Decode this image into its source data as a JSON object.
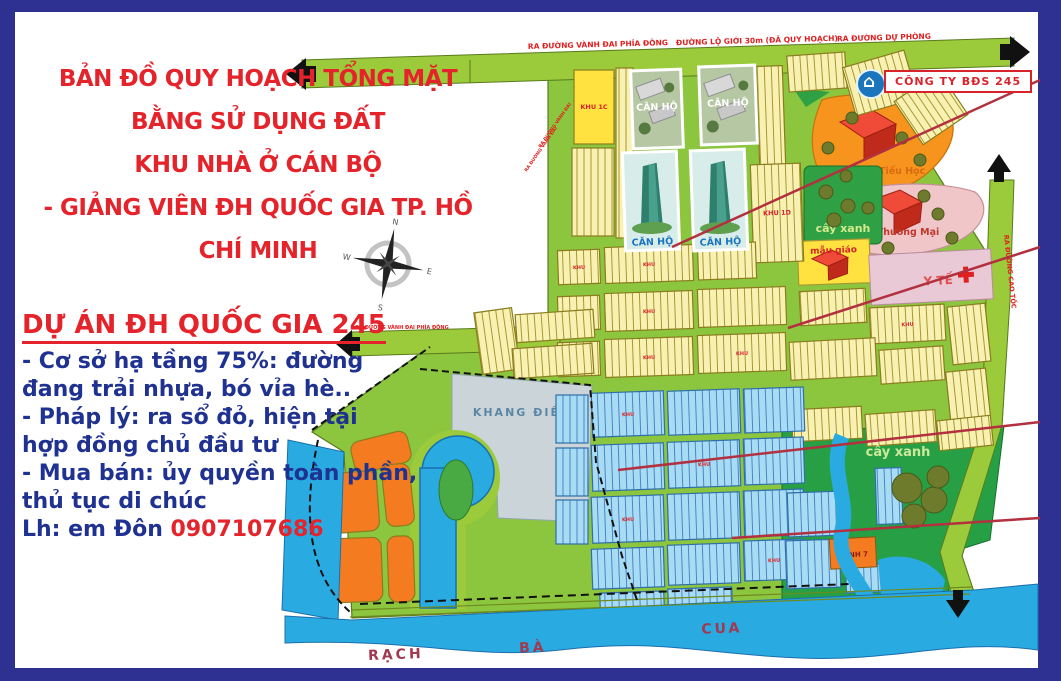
{
  "title": {
    "line1": "BẢN ĐỒ QUY HOẠCH TỔNG MẶT BẰNG SỬ DỤNG ĐẤT",
    "line2": "KHU NHÀ Ở CÁN BỘ",
    "line3": "- GIẢNG VIÊN ĐH QUỐC GIA TP. HỒ CHÍ MINH"
  },
  "info_panel": {
    "heading": "DỰ ÁN ĐH QUỐC GIA 245",
    "lines": [
      "- Cơ sở hạ tầng 75%: đường",
      "đang trải nhựa, bó vỉa hè..",
      "- Pháp lý:  ra sổ đỏ, hiện tại",
      "hợp đồng chủ đầu tư",
      "- Mua bán: ủy quyền toàn phần,",
      "thủ tục di chúc"
    ],
    "contact_label": "Lh: em Đôn ",
    "contact_phone": "0907107686"
  },
  "company_badge": {
    "label": "CÔNG TY BĐS 245",
    "icon": "house-icon"
  },
  "roads": {
    "top_left": "RA ĐƯỜNG VÀNH ĐAI PHÍA ĐÔNG",
    "top_center": "ĐƯỜNG LỘ GIỚI 30m (ĐÃ QUY HOẠCH)",
    "top_right": "RA ĐƯỜNG DỰ PHÒNG",
    "highway_right": "RA ĐƯỜNG CAO TỐC",
    "west_arm": "RA ĐƯỜNG VÀNH ĐAI PHÍA ĐÔNG",
    "left_diagonal": "RA ĐƯỜNG VÀNH ĐAI"
  },
  "map": {
    "labels": {
      "khu_1c": "KHU 1C",
      "khu_1d": "KHU 1D",
      "khu_generic": "KHU",
      "can_ho": "CĂN HỘ",
      "truong_tieu_hoc": "Trường Tiểu Học",
      "thuong_mai": "Thương Mại",
      "cay_xanh": "cây xanh",
      "mau_giao": "mẫu giáo",
      "y_te": "Y TẾ",
      "khang_dien": "KHANG ĐIỀN",
      "xanh_7": "XANH 7"
    },
    "rivers": {
      "r1": "RẠCH",
      "r2": "BÀ",
      "r3": "CUA"
    },
    "compass": {
      "n": "N",
      "e": "E",
      "s": "S",
      "w": "W"
    }
  },
  "colors": {
    "frame_navy": "#2E3192",
    "title_red": "#E4232B",
    "info_blue": "#1F3191",
    "map_green": "#8CC63F",
    "road_green": "#9BCB3B",
    "parcel_yellow": "#F8F1B2",
    "bright_yellow": "#FFE23F",
    "parcel_blue": "#A8DCF5",
    "orange": "#F47B20",
    "river_blue": "#29ABE2",
    "park_green": "#27A045",
    "school_orange": "#F7941D",
    "commercial_pink": "#F0C6C9",
    "medical_pink": "#E9C9D6",
    "khang_dien_gray": "#CBD4D8",
    "callout_red": "#B2303F"
  }
}
